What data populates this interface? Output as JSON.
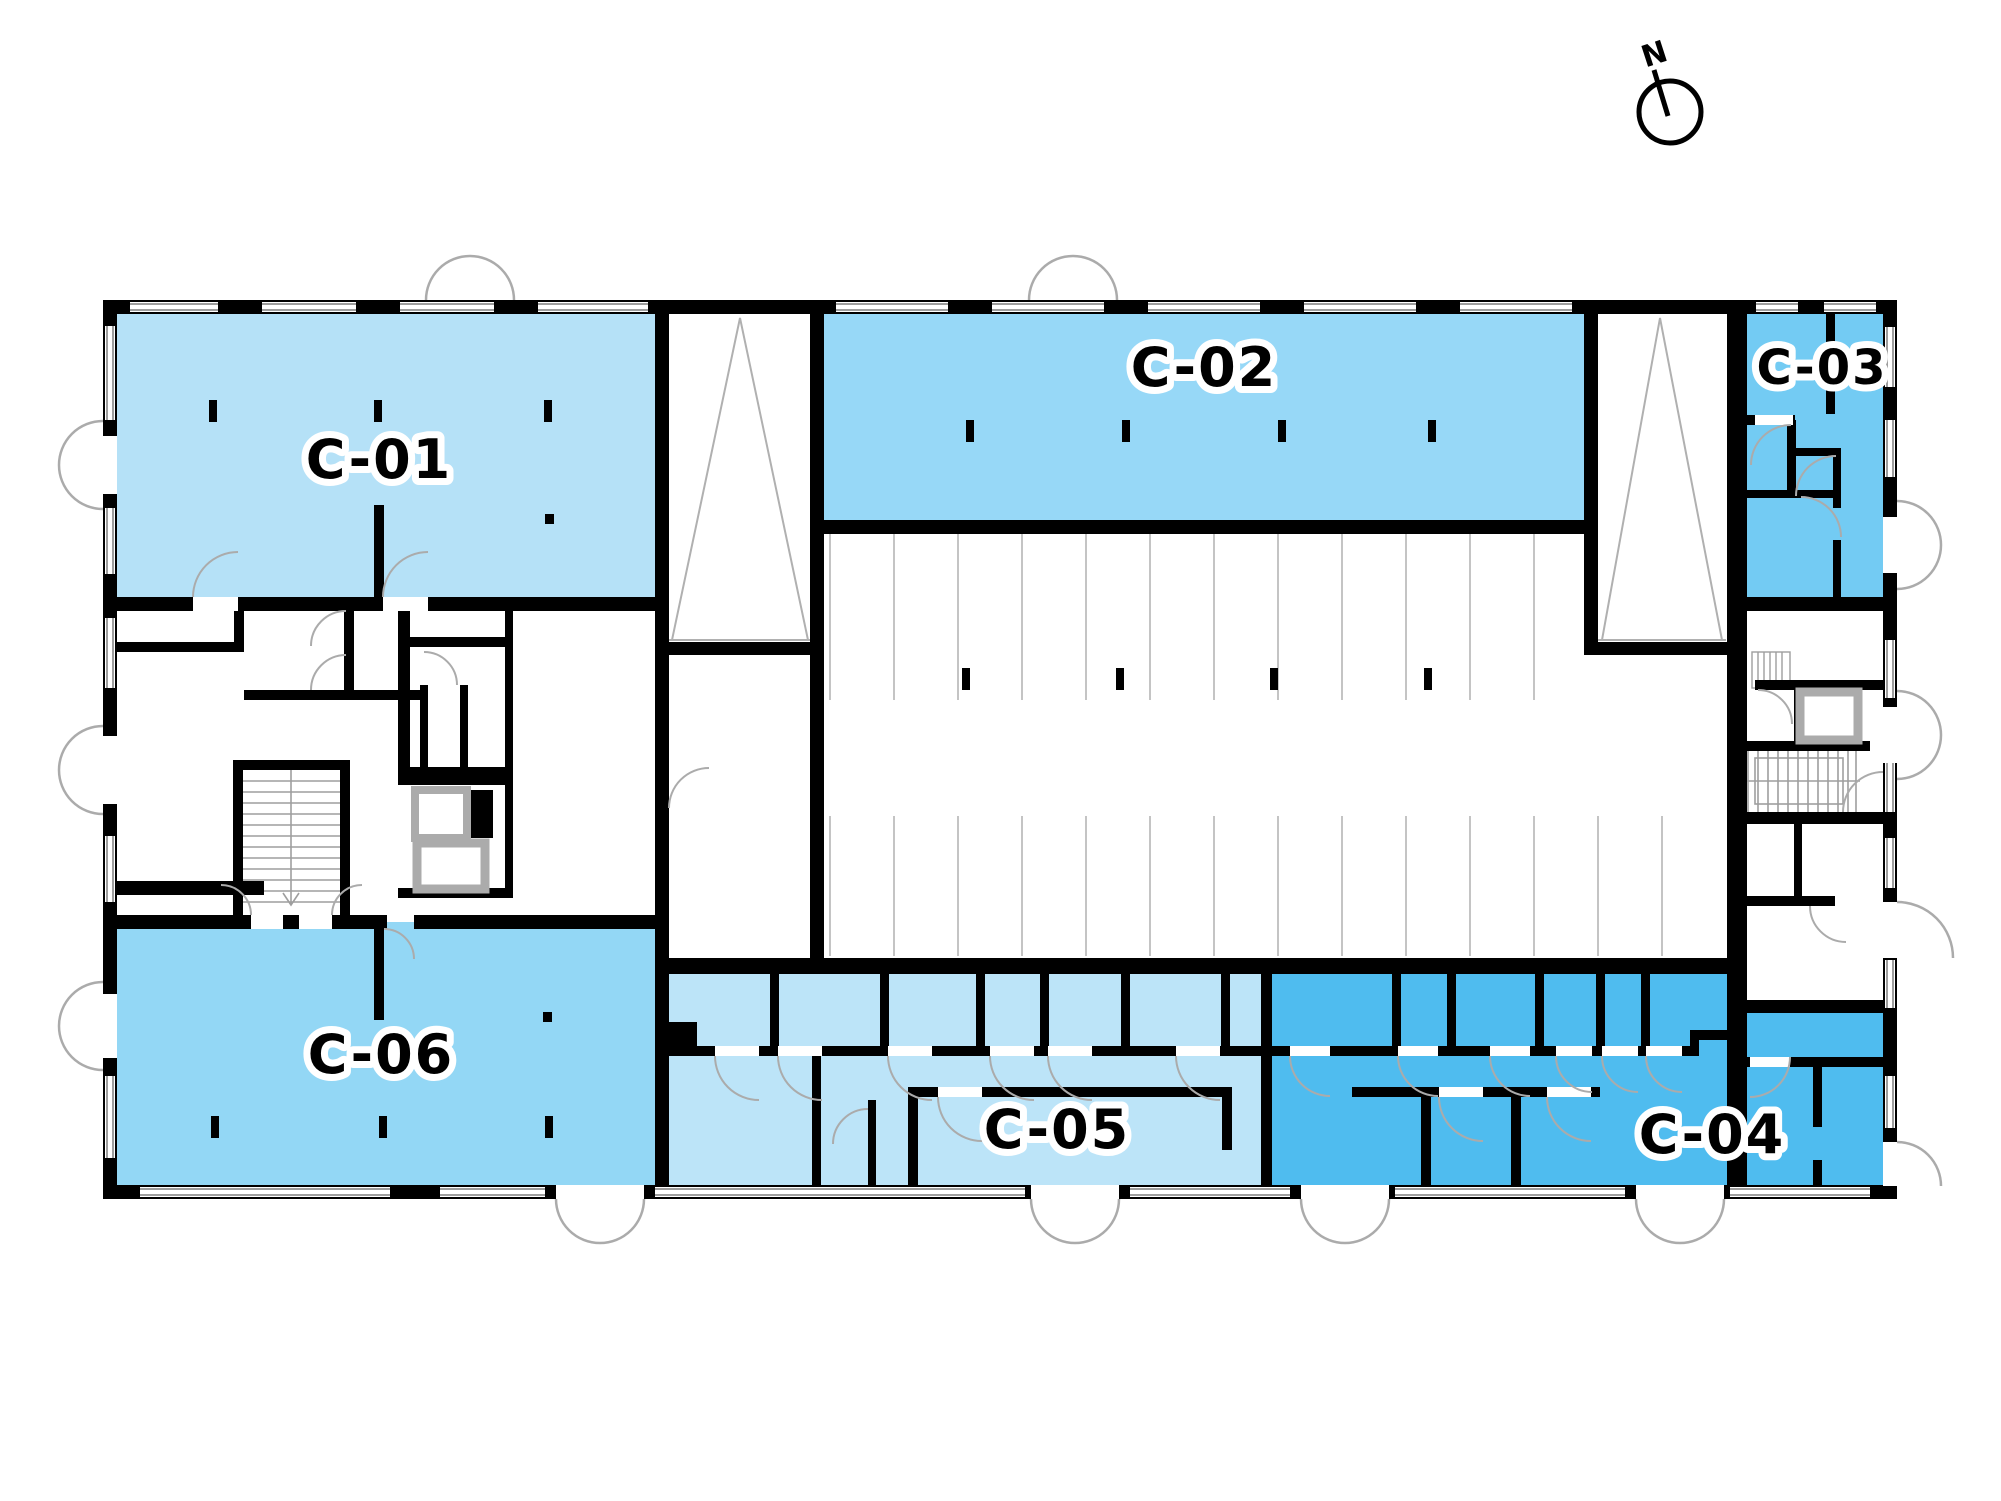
{
  "plan": {
    "name": "Floor plan with unit availability",
    "compass": {
      "label": "N"
    },
    "units": [
      {
        "id": "c01",
        "label": "C-01",
        "color": "#B5E1F7"
      },
      {
        "id": "c02",
        "label": "C-02",
        "color": "#97D8F7"
      },
      {
        "id": "c03",
        "label": "C-03",
        "color": "#73CBF3"
      },
      {
        "id": "c04",
        "label": "C-04",
        "color": "#4FBCEF"
      },
      {
        "id": "c05",
        "label": "C-05",
        "color": "#BCE4F8"
      },
      {
        "id": "c06",
        "label": "C-06",
        "color": "#93D7F5"
      }
    ],
    "colors": {
      "wall": "#000000",
      "door_swing": "#ABABAB",
      "window_frame": "#9E9E9E",
      "parking_line": "#C4C4C4",
      "elevator_frame": "#ABABAB",
      "ramp_line": "#B0B0B0",
      "background": "#FFFFFF"
    }
  }
}
